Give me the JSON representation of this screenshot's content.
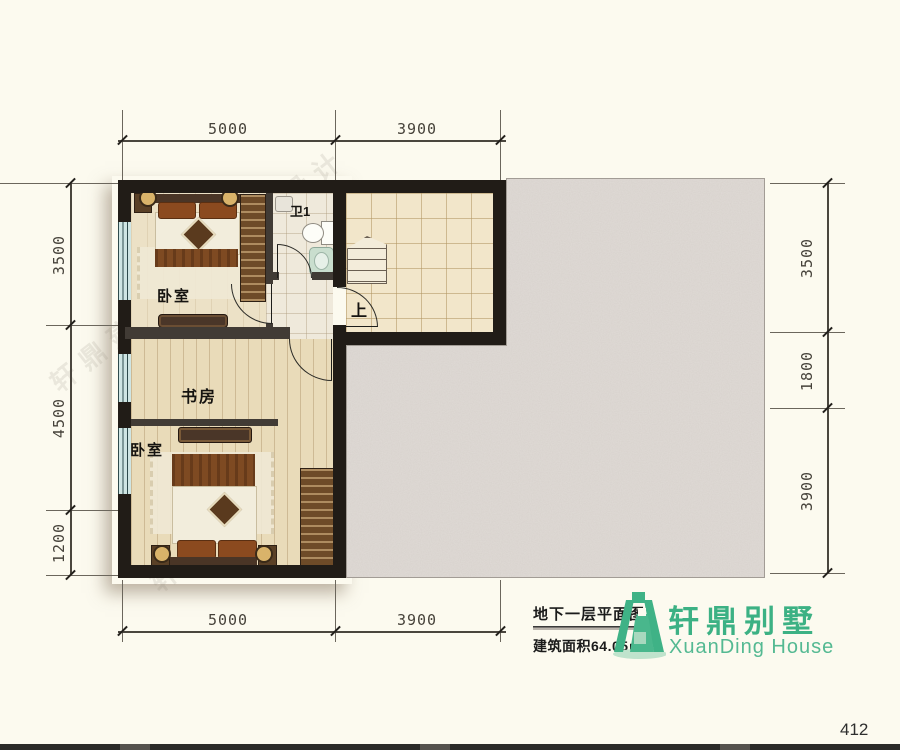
{
  "page": {
    "number": "412"
  },
  "watermark": {
    "text": "轩鼎建筑设计"
  },
  "plan": {
    "labels": {
      "bedroom_top": "卧室",
      "bath": "卫1",
      "up": "上",
      "study": "书房",
      "bedroom_bottom": "卧室"
    },
    "dims": {
      "top": [
        "5000",
        "3900"
      ],
      "bottom": [
        "5000",
        "3900"
      ],
      "left": [
        "3500",
        "4500",
        "1200"
      ],
      "right": [
        "3500",
        "1800",
        "3900"
      ]
    }
  },
  "title_block": {
    "plan_title": "地下一层平面图",
    "area_text": "建筑面积64.05㎡",
    "brand_cn": "轩鼎别墅",
    "brand_en": "XuanDing House",
    "brand_color": "#3CB184"
  }
}
